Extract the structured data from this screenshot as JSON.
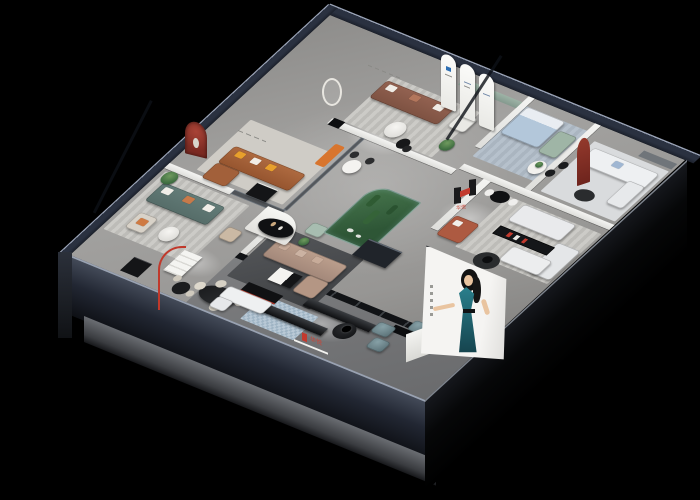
{
  "scene": {
    "description": "3D isometric cutaway render of a furniture showroom interior on a black background",
    "background_color": "#000000",
    "brand": {
      "logo_letter_shape": "H",
      "name_cn": "华悦",
      "logo_red": "#c23a2e",
      "logo_black": "#1a1a1c",
      "sign_locations": [
        "interior display wall",
        "front fascia low wall"
      ]
    },
    "poster": {
      "subject": "fashion model in teal evening dress, hand on hip",
      "panel_color": "#f3f2f0",
      "dress_color": "#1f6a78",
      "hair_color": "#121212",
      "tagline": "vertical micro-text (illegible)"
    },
    "exterior": {
      "outer_wall_color": "#2a3140",
      "wall_top_highlight": "#9aa3b6",
      "fascia_color": "#222733",
      "slab_color": "#6a6d72"
    },
    "rooms": [
      {
        "name": "top-center-lounge",
        "items": [
          "brown leather sofa with white pillows",
          "white armchair",
          "round white coffee table",
          "black nesting tables",
          "potted plant",
          "striped rug",
          "recessed green display niche",
          "round wall mirror",
          "illegible wall lettering",
          "wall TV panel"
        ]
      },
      {
        "name": "gallery-green-wall",
        "items": [
          "sage green accent wall",
          "three white arched display panels with small blue logos"
        ]
      },
      {
        "name": "blue-bedroom",
        "items": [
          "light blue bed",
          "mint loveseat",
          "white round table with plant",
          "two black chairs",
          "blue-gray rug"
        ]
      },
      {
        "name": "white-corner-lounge",
        "items": [
          "white modular sofa with blue pillow",
          "dark oval coffee table",
          "dark red arched wall niche",
          "gray media panel"
        ]
      },
      {
        "name": "right-middle-lounge",
        "items": [
          "white fabric sofas",
          "black media shelf with red accents",
          "rust-red loveseat",
          "brand H logo wall",
          "small black table with two white chairs",
          "white chaise",
          "black round rug with black side table"
        ]
      },
      {
        "name": "cognac-room",
        "items": [
          "cognac leather sectional with yellow pillows",
          "black coffee table",
          "red arched niche with figurine",
          "illegible wall lettering",
          "orange accent bench"
        ]
      },
      {
        "name": "teal-living-room",
        "items": [
          "slate-teal sofa with white and orange pillows",
          "beige armchair",
          "round white coffee table",
          "potted plant",
          "striped rug",
          "black display cabinet",
          "small black bistro table with chairs",
          "grooved wall relief"
        ]
      },
      {
        "name": "center-living",
        "items": [
          "taupe L-shaped sectional",
          "white curved display partition",
          "black oval table with vases",
          "white and black coffee table",
          "mint armchair",
          "dark area rug",
          "dark kitchen counter"
        ]
      },
      {
        "name": "cactus-garden",
        "items": [
          "glass enclosure with rounded corner",
          "green ground",
          "cacti and shrubs",
          "white pebbles"
        ]
      },
      {
        "name": "dining-area",
        "items": [
          "black oval dining table",
          "four cream chairs",
          "red arc floor lamp",
          "white shelving unit",
          "black sideboard with red stripe"
        ]
      },
      {
        "name": "front-walkway",
        "items": [
          "two long black benches",
          "three teal leather ottomans",
          "round black table with black lamp",
          "pixel-pattern light blue rug",
          "white L-shaped sofa",
          "black display console",
          "brand sign on low wall",
          "large model poster on front wall"
        ]
      }
    ],
    "palette": {
      "floor": "#9b9a97",
      "walkway": "#77787a",
      "street_strip": "#111316",
      "teal_sofa": "#5a716d",
      "cognac_sofa": "#a2603a",
      "brown_sofa": "#8a5b45",
      "taupe_sectional": "#b49684",
      "blue_bed": "#b3c7da",
      "mint": "#a3b8a9",
      "rust_loveseat": "#ad5a41",
      "ottoman_teal": "#647d84",
      "cactus_green": "#3c6b42",
      "sage_wall": "#90a69b",
      "arch_red": "#7d2b23"
    }
  }
}
